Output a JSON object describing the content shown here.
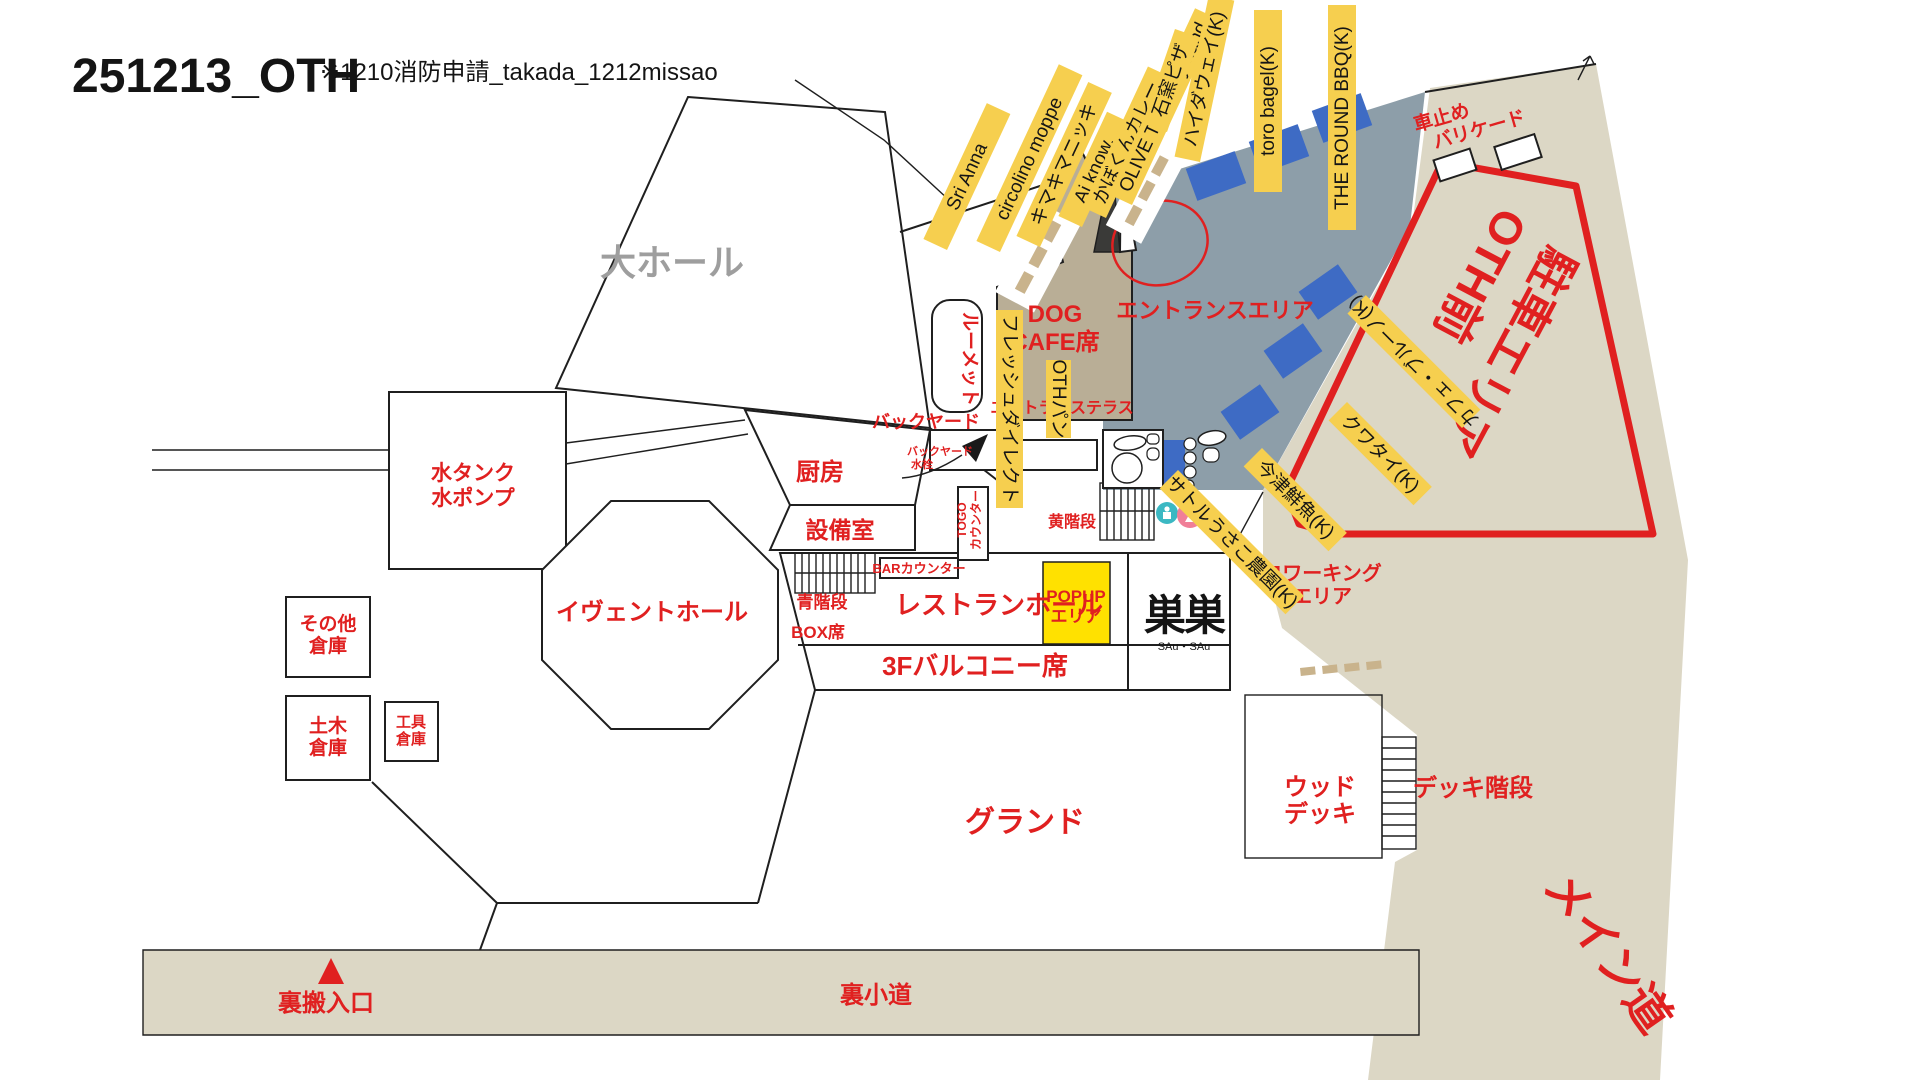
{
  "header": {
    "title": "251213_OTH",
    "subtitle": "※1210消防申請_takada_1212missao"
  },
  "vendors": [
    {
      "label": "Sri Anna"
    },
    {
      "label": "circolino moppe"
    },
    {
      "label": "キマキマニッキ"
    },
    {
      "label": "Ai know."
    },
    {
      "label": "かぼくんカレー"
    },
    {
      "label": "OLIVE TREE by hand"
    },
    {
      "label": "石窯ピザ"
    },
    {
      "label": "ハイダウェイ(K)"
    },
    {
      "label": "toro bagel(K)"
    },
    {
      "label": "THE ROUND BBQ(K)"
    },
    {
      "label": "フレッシュダイレクト"
    },
    {
      "label": "OTHパン"
    },
    {
      "label": "カフェ・ブルーノ(K)"
    },
    {
      "label": "クワタイ(K)"
    },
    {
      "label": "今津鮮魚(K)"
    },
    {
      "label": "サトルうさこ農園(K)"
    }
  ],
  "areas": {
    "big_hall": "大ホール",
    "water_tank_l1": "水タンク",
    "water_tank_l2": "水ポンプ",
    "kitchen": "厨房",
    "event_hall": "イヴェントホール",
    "other_storage_l1": "その他",
    "other_storage_l2": "倉庫",
    "civil_storage_l1": "土木",
    "civil_storage_l2": "倉庫",
    "tool_storage_l1": "工具",
    "tool_storage_l2": "倉庫",
    "equipment_room": "設備室",
    "blue_stairs": "青階段",
    "box_seats": "BOX席",
    "bar_counter": "BARカウンター",
    "togo_l1": "TOGO",
    "togo_l2": "カウンター",
    "restaurant_hall": "レストランホール",
    "balcony_3f": "3Fバルコニー席",
    "popup_l1": "POPUP",
    "popup_l2": "エリア",
    "susu_logo": "巣巣",
    "susu_sub": "SAu・SAu",
    "coworking_l1": "コワーキング",
    "coworking_l2": "エリア",
    "yellow_stairs": "黄階段",
    "ground": "グランド",
    "wood_deck_l1": "ウッド",
    "wood_deck_l2": "デッキ",
    "deck_stairs": "デッキ階段",
    "back_path": "裏小道",
    "back_entrance": "裏搬入口",
    "main_road": "メイン道",
    "oth_parking_l1": "OTH前",
    "oth_parking_l2": "駐車エリア",
    "car_stop_l1": "車止め",
    "car_stop_l2": "バリケード",
    "entrance_area": "エントランスエリア",
    "dog_cafe_l1": "DOG",
    "dog_cafe_l2": "CAFE席",
    "entrance_terrace": "エントランステラス",
    "roomette": "ルーメット",
    "backyard": "バックヤード",
    "backyard_tap_l1": "バックヤード",
    "backyard_tap_l2": "水栓"
  },
  "colors": {
    "red": "#E02020",
    "vendor_label_yellow": "#F6CF4F",
    "popup_yellow": "#FFE100",
    "entrance_gray": "#8D9EA9",
    "terrace_tan": "#B9AE96",
    "road_beige": "#DCD7C5",
    "kitchen_car_blue": "#3E6BC4",
    "hall_gray_text": "#9E9E9E",
    "toilet_pink": "#F07F98",
    "toilet_teal": "#3BB8C3"
  }
}
